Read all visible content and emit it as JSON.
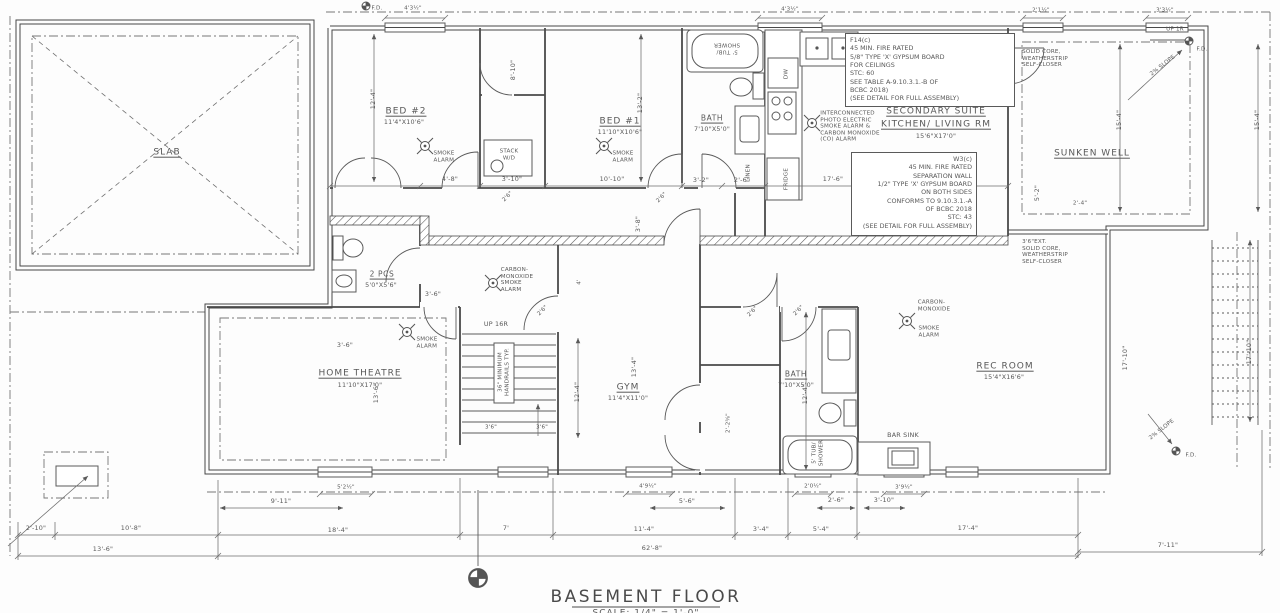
{
  "title": {
    "name": "BASEMENT FLOOR",
    "scale": "SCALE: 1/4\" = 1'-0\""
  },
  "rooms": {
    "slab": "SLAB",
    "bed2": {
      "name": "BED #2",
      "size": "11'4\"X10'6\""
    },
    "bed1": {
      "name": "BED #1",
      "size": "11'10\"X10'6\""
    },
    "bath_upper": {
      "name": "BATH",
      "size": "7'10\"X5'0\""
    },
    "suite": {
      "line1": "SECONDARY SUITE",
      "line2": "KITCHEN/ LIVING RM",
      "size": "15'6\"X17'0\""
    },
    "sunken_well": "SUNKEN WELL",
    "two_pcs": {
      "name": "2 PCS",
      "size": "5'0\"X5'6\""
    },
    "home_theatre": {
      "name": "HOME THEATRE",
      "size": "11'10\"X17'0\""
    },
    "gym": {
      "name": "GYM",
      "size": "11'4\"X11'0\""
    },
    "bath_lower": {
      "name": "BATH",
      "size": "7'10\"X5'0\""
    },
    "rec_room": {
      "name": "REC ROOM",
      "size": "15'4\"X16'6\""
    }
  },
  "fixtures": {
    "tub_shower": [
      "5' TUB/",
      "SHOWER"
    ],
    "stack_wd": [
      "STACK",
      "W/D"
    ],
    "dw": "DW",
    "fridge": "FRIDGE",
    "linen": "LINEN",
    "bar_sink": "BAR SINK"
  },
  "alarms": {
    "smoke": [
      "SMOKE",
      "ALARM"
    ],
    "co_smoke": [
      "CARBON-",
      "MONOXIDE",
      "SMOKE",
      "ALARM"
    ],
    "co_top": [
      "CARBON-",
      "MONOXIDE"
    ],
    "smoke_only": [
      "SMOKE",
      "ALARM"
    ],
    "interconnected": [
      "INTERCONNECTED",
      "PHOTO ELECTRIC",
      "SMOKE ALARM &",
      "CARBON MONOXIDE",
      "(CO) ALARM"
    ]
  },
  "notes": {
    "f14": [
      "F14(c)",
      "45 MIN. FIRE RATED",
      "5/8\" TYPE 'X' GYPSUM BOARD",
      "FOR CEILINGS",
      "STC: 60",
      "SEE TABLE A-9.10.3.1.-B OF",
      "BCBC 2018)",
      "(SEE DETAIL FOR FULL ASSEMBLY)"
    ],
    "w3": [
      "W3(c)",
      "45 MIN. FIRE RATED",
      "SEPARATION WALL",
      "1/2\" TYPE 'X' GYPSUM BOARD",
      "ON BOTH SIDES",
      "CONFORMS TO 9.10.3.1.-A",
      "OF BCBC 2018",
      "STC: 43",
      "(SEE DETAIL FOR FULL ASSEMBLY)"
    ],
    "door_top": [
      "SOLID CORE,",
      "WEATHERSTRIP",
      "SELF-CLOSER"
    ],
    "door_mid": [
      "3'6\"EXT.",
      "SOLID CORE,",
      "WEATHERSTRIP",
      "SELF-CLOSER"
    ],
    "handrail": [
      "36\" MINIMUM",
      "HANDRAILS TYP."
    ],
    "up16r": "UP 16R",
    "up1r": "UP 1R",
    "slope": "2% SLOPE",
    "fd": "F.D."
  },
  "dims": {
    "t1": "4'3½\"",
    "t2": "4'3½\"",
    "t3": "2'1½\"",
    "t4": "3'3½\"",
    "m1": "4'-8\"",
    "m2": "3'-10\"",
    "m3": "10'-10\"",
    "m4": "3'-2\"",
    "m5": "2'-6\"",
    "m6": "17'-6\"",
    "v1": "12'-4\"",
    "v2": "8'-10\"",
    "v3": "13'-2\"",
    "v4": "3'-8\"",
    "v5": "15'-4\"",
    "v6": "15'-4\"",
    "v7": "17'-10\"",
    "v8": "17'-10\"",
    "v9": "12'-4\"",
    "v10": "13'-4\"",
    "v11": "12'-4\"",
    "v12": "13'-6\"",
    "v13": "5'-2\"",
    "v14": "2'-4\"",
    "v15": "4'",
    "h1": "3'-6\"",
    "h2": "3'-6\"",
    "h3": "3'6\"",
    "h4": "3'6\"",
    "d26": "2'6\"",
    "d225": "2'-2⅝\"",
    "a1": "9'-11\"",
    "a2": "5'-6\"",
    "a3": "2'-6\"",
    "a4": "3'-10\"",
    "w1": "5'2½\"",
    "w2": "4'9½\"",
    "w3": "2'0½\"",
    "w4": "3'9½\"",
    "b1": "2'-10\"",
    "b2": "10'-8\"",
    "b3": "18'-4\"",
    "b4": "7'",
    "b5": "11'-4\"",
    "b6": "3'-4\"",
    "b7": "5'-4\"",
    "b8": "17'-4\"",
    "b9": "7'-11\"",
    "c1": "13'-6\"",
    "c2": "62'-8\""
  }
}
